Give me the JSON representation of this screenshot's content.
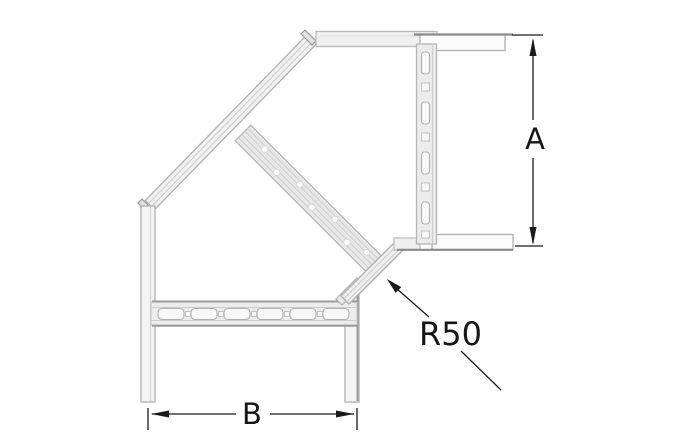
{
  "drawing": {
    "subject": "cable-ladder-90-degree-bend-plan-view",
    "labels": {
      "dim_a": "A",
      "dim_b": "B",
      "radius": "R50"
    },
    "icons": {
      "arrow_up": "dimension-arrowhead-up",
      "arrow_down": "dimension-arrowhead-down",
      "arrow_left": "dimension-arrowhead-left",
      "arrow_right": "dimension-arrowhead-right",
      "leader_arrow": "leader-arrowhead-up-left"
    },
    "colors": {
      "background": "#ffffff",
      "structure_line": "#b5b5b5",
      "structure_inner_line": "#cdcdcd",
      "structure_dark_edge": "#8a8a8a",
      "structure_fill": "#f1f1f1",
      "dimension": "#1a1a1a"
    }
  }
}
